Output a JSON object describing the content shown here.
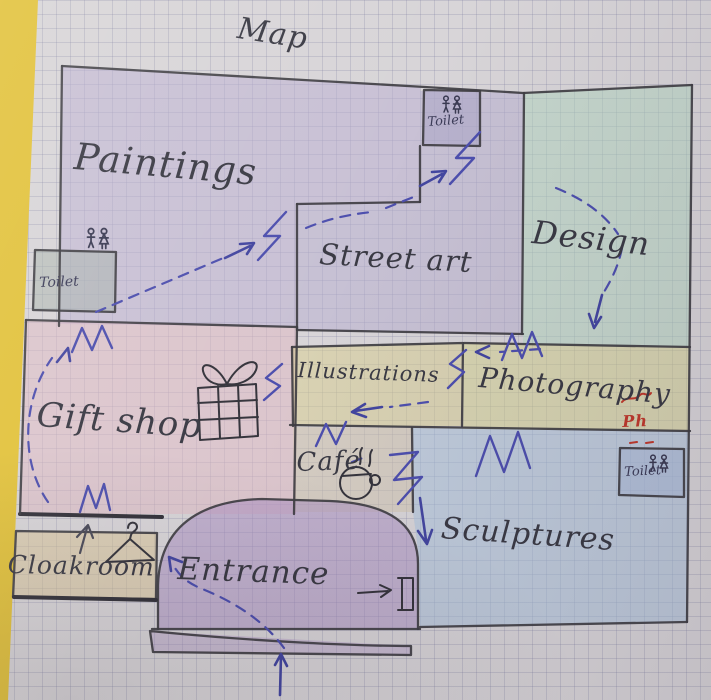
{
  "title": "Map",
  "rooms": {
    "paintings": {
      "label": "Paintings"
    },
    "street_art": {
      "label": "Street art"
    },
    "design": {
      "label": "Design"
    },
    "gift_shop": {
      "label": "Gift shop"
    },
    "illustrations": {
      "label": "Illustrations"
    },
    "photography": {
      "label": "Photography",
      "correction": "Ph"
    },
    "cafe": {
      "label": "Café"
    },
    "sculptures": {
      "label": "Sculptures"
    },
    "cloakroom": {
      "label": "Cloakroom"
    },
    "entrance": {
      "label": "Entrance"
    }
  },
  "toilets": {
    "top": "Toilet",
    "left": "Toilet",
    "bottom_right": "Toilet"
  },
  "colors": {
    "paper": "#d8d5d8",
    "grid": "#7a7a9e",
    "desk_edge": "#e2c23c",
    "wall": "#3f3e43",
    "route": "#4d4fae",
    "correction_red": "#c0392b",
    "rooms": {
      "paintings": "#b9aed2",
      "street_art": "#b6add0",
      "design": "#b2d8c0",
      "gift_shop": "#e0b8c2",
      "illustrations": "#d9cf8e",
      "photography": "#d6d38a",
      "cafe": "#cfc4ab",
      "sculptures": "#a6c2de",
      "cloakroom": "#dcc592",
      "entrance": "#a88bc2",
      "toilet_top": "#a9a3c6",
      "toilet_left": "#a6b2aa",
      "toilet_br": "#a8b8d8"
    }
  }
}
